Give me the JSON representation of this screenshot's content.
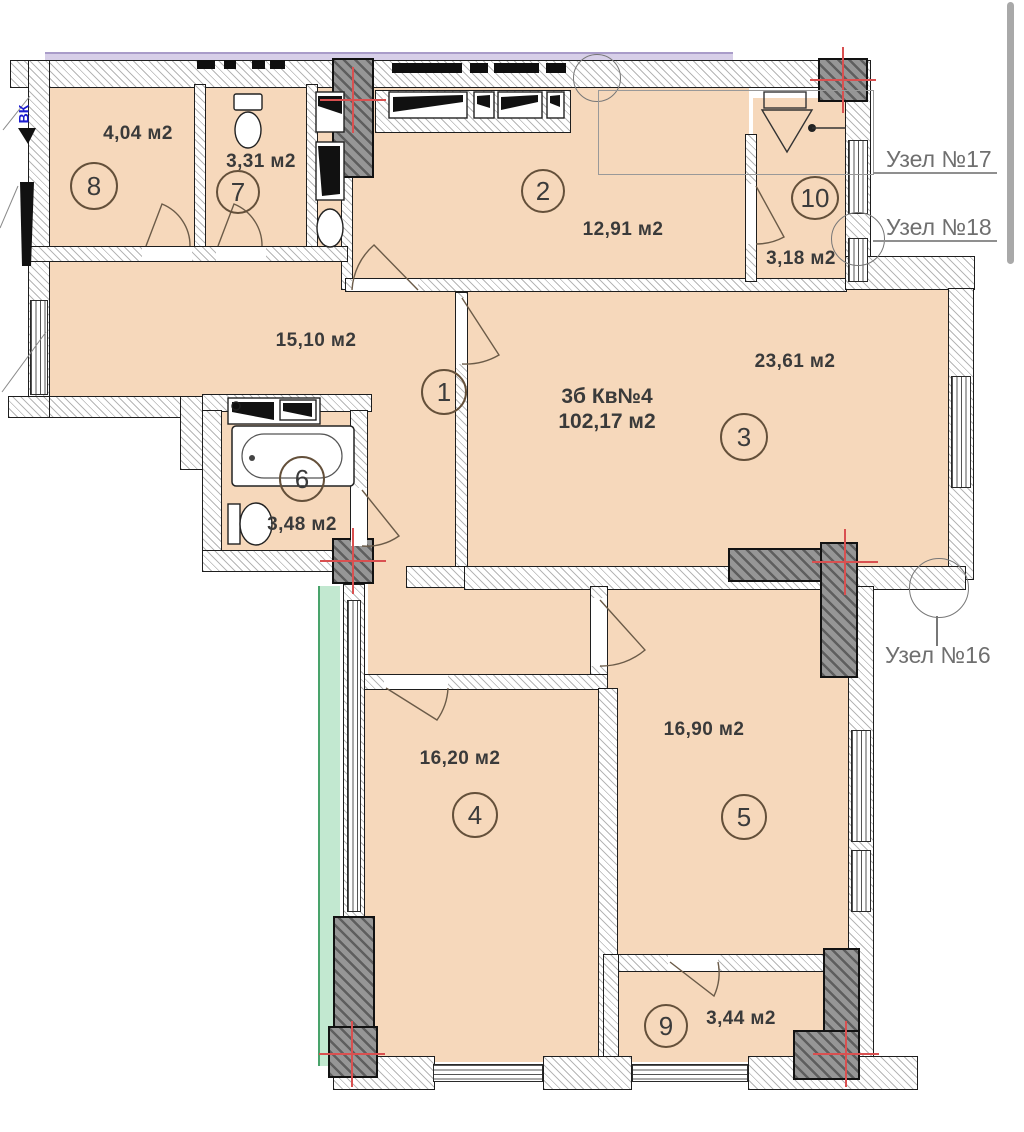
{
  "plan": {
    "apartment": {
      "type_label": "3б Кв№4",
      "total_area": "102,17 м2"
    },
    "rooms": [
      {
        "id": "8",
        "area": "4,04 м2"
      },
      {
        "id": "7",
        "area": "3,31 м2"
      },
      {
        "id": "2",
        "area": "12,91 м2"
      },
      {
        "id": "10",
        "area": "3,18 м2"
      },
      {
        "id": "1",
        "area": "15,10 м2"
      },
      {
        "id": "3",
        "area": "23,61 м2"
      },
      {
        "id": "6",
        "area": "3,48 м2"
      },
      {
        "id": "4",
        "area": "16,20 м2"
      },
      {
        "id": "5",
        "area": "16,90 м2"
      },
      {
        "id": "9",
        "area": "3,44 м2"
      }
    ],
    "callouts": {
      "node17": "Узел №17",
      "node18": "Узел №18",
      "node16": "Узел №16"
    },
    "annotations": {
      "duct": "ВК"
    },
    "colors": {
      "floor_fill": "#f6d8bb",
      "wall_fill": "#ffffff",
      "column_fill": "#969696",
      "accent_red": "#d95050",
      "balcony_green": "#c2e8d0",
      "facade_strip": "#d7cfe8",
      "callout_text": "#6f6f6f"
    }
  }
}
